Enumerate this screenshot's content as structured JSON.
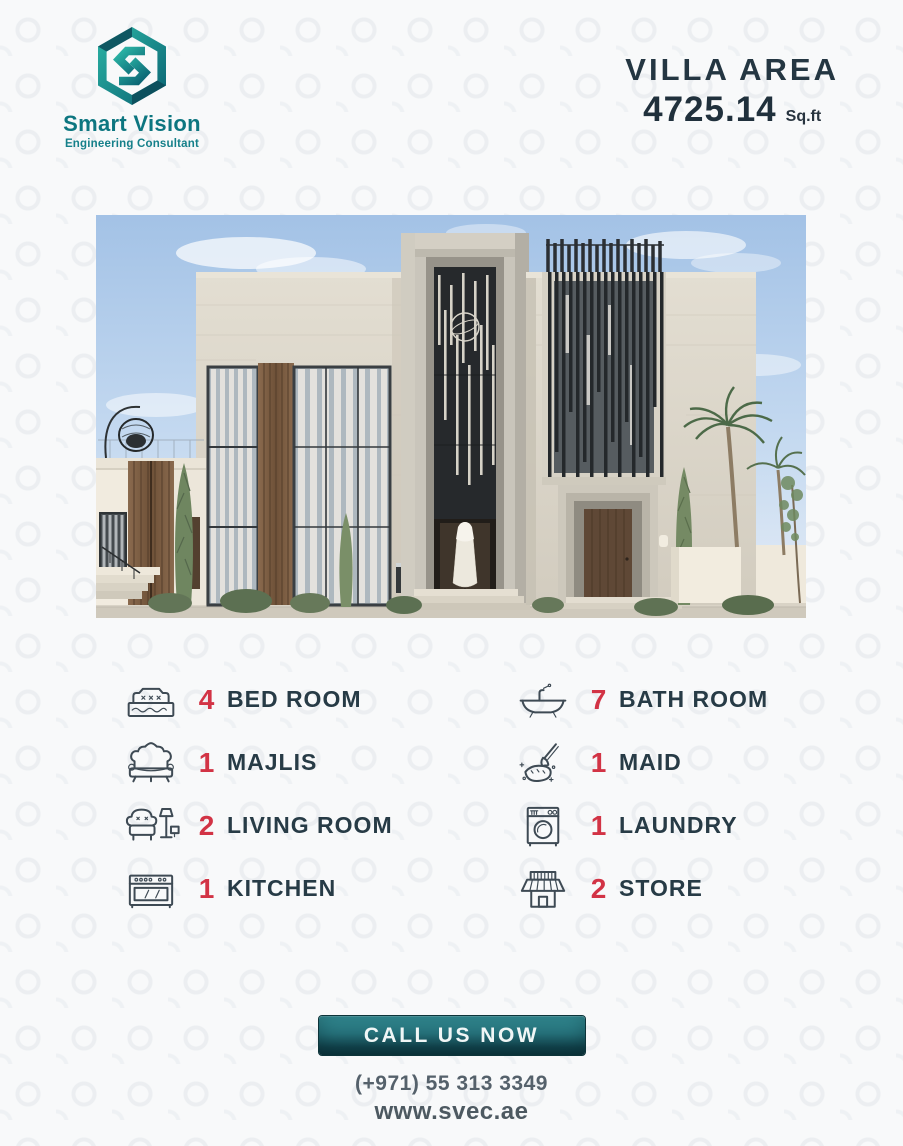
{
  "brand": {
    "name": "Smart Vision",
    "tagline": "Engineering Consultant"
  },
  "header": {
    "area_label": "VILLA AREA",
    "area_value": "4725.14",
    "area_unit": "Sq.ft"
  },
  "features": {
    "left": [
      {
        "icon": "bed-icon",
        "count": "4",
        "label": "BED ROOM"
      },
      {
        "icon": "sofa-icon",
        "count": "1",
        "label": "MAJLIS"
      },
      {
        "icon": "armchair-lamp-icon",
        "count": "2",
        "label": "LIVING ROOM"
      },
      {
        "icon": "stove-icon",
        "count": "1",
        "label": "KITCHEN"
      }
    ],
    "right": [
      {
        "icon": "bathtub-icon",
        "count": "7",
        "label": "BATH ROOM"
      },
      {
        "icon": "cleaning-icon",
        "count": "1",
        "label": "MAID"
      },
      {
        "icon": "washing-machine-icon",
        "count": "1",
        "label": "LAUNDRY"
      },
      {
        "icon": "storefront-icon",
        "count": "2",
        "label": "STORE"
      }
    ]
  },
  "cta": {
    "button_label": "CALL US NOW",
    "phone": "(+971) 55 313 3349",
    "website": "www.svec.ae"
  },
  "colors": {
    "accent_red": "#d23345",
    "text_dark": "#273b46",
    "brand_teal": "#0d7680",
    "button_teal_light": "#37949c",
    "button_teal_dark": "#0c353c",
    "muted_gray": "#55616b"
  }
}
